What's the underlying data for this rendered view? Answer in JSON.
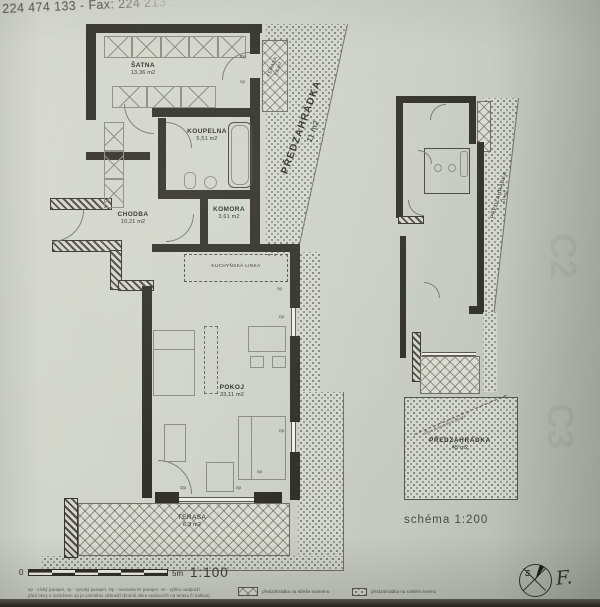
{
  "header": {
    "phone_fax": "224 474 133 - Fax: 224 213 ..."
  },
  "main_plan": {
    "rooms": [
      {
        "name": "ŠATNA",
        "area": "13,36 m2"
      },
      {
        "name": "KOUPELNA",
        "area": "5,51 m2"
      },
      {
        "name": "CHODBA",
        "area": "10,21 m2"
      },
      {
        "name": "KOMORA",
        "area": "3,61 m2"
      },
      {
        "name": "POKOJ",
        "area": "33,11 m2"
      },
      {
        "name": "TERASA",
        "area": "6,3 m2"
      },
      {
        "name": "TERASA",
        "area": "1,8 m2"
      },
      {
        "name": "PŘEDZAHRÁDKA",
        "area": "11 m2"
      }
    ],
    "kitchen_label": "KUCHYŇSKÁ LINKA",
    "marks": {
      "np": "np",
      "op": "Op"
    }
  },
  "schema_plan": {
    "caption": "schéma 1:200",
    "predzahradka_side": {
      "name": "PŘEDZAHRÁDKA",
      "area": "11 m2"
    },
    "predzahradka_bottom": {
      "name": "PŘEDZAHRÁDKA",
      "area": "45 m2"
    },
    "garage_note": "obrys podzemních garáží"
  },
  "footer": {
    "scale_zero": "0",
    "scale_five": "5m",
    "scale_ratio": "1:100",
    "note_line1": "np - nízký parapet, vp - vysoký parapet, Op - meziokenní parapet, vn - výška nadpraží",
    "note_line2": "před okny s rozměrem np je umístěno zábradlí (kromě oken vedoucích na terasu či balkon)",
    "legend": [
      {
        "label": "předzahrádka na střeše suterénu"
      },
      {
        "label": "předzahrádka na rostlém terénu"
      }
    ],
    "compass_letter": "S",
    "signature": "F."
  },
  "bleed_marks": {
    "m1": "C2",
    "m2": "C3"
  }
}
